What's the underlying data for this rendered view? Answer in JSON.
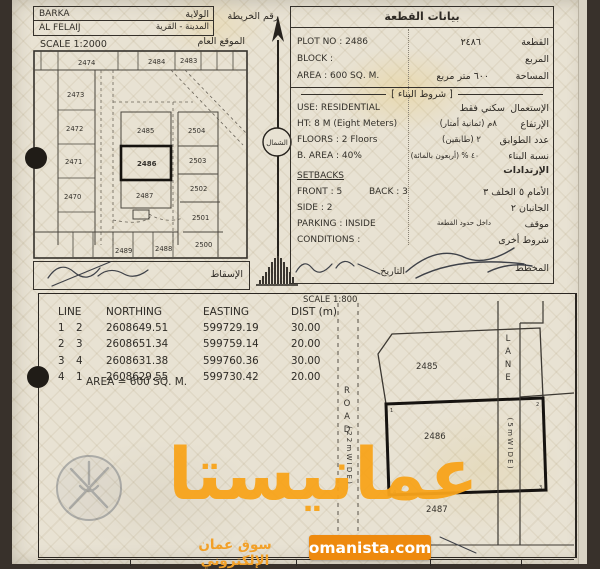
{
  "header": {
    "city": "BARKA",
    "village": "AL FELAIJ",
    "state_label": "الولاية",
    "city_village_label": "المدينة - القرية",
    "map_no_label": "رقم الخريطة"
  },
  "location_map": {
    "scale": "SCALE 1:2000",
    "title": "الموقع العام",
    "projection_label": "الإسقاط",
    "plots": {
      "p2474": "2474",
      "p2484": "2484",
      "p2483": "2483",
      "p2473": "2473",
      "p2472": "2472",
      "p2471": "2471",
      "p2470": "2470",
      "p2485": "2485",
      "p2486": "2486",
      "p2487": "2487",
      "p2504": "2504",
      "p2503": "2503",
      "p2502": "2502",
      "p2501": "2501",
      "p2500": "2500",
      "p2489": "2489",
      "p2488": "2488"
    }
  },
  "north": {
    "label": "الشمال"
  },
  "plot_data": {
    "title": "بيانات القطعة",
    "plot_no_en": "PLOT NO :  2486",
    "plot_no_ar": "٢٤٨٦",
    "plot_label_ar": "القطعة",
    "block_en": "BLOCK :",
    "block_label_ar": "المربع",
    "area_en": "AREA :  600 SQ. M.",
    "area_ar": "٦٠٠    متر مربع",
    "area_label_ar": "المساحة",
    "conditions_header_ar": "[ شروط البناء ]",
    "use_en": "USE: RESIDENTIAL",
    "use_ar": "سكني فقط",
    "use_label_ar": "الإستعمال",
    "ht_en": "HT: 8 M  (Eight Meters)",
    "ht_ar": "٨م  (ثمانية أمتار)",
    "ht_label_ar": "الإرتفاع",
    "floors_en": "FLOORS :  2 Floors",
    "floors_ar": "٢  (طابقين)",
    "floors_label_ar": "عدد الطوابق",
    "barea_en": "B. AREA :    40%",
    "barea_ar": "٤٠ %  (أربعون بالمائة)",
    "barea_label_ar": "نسبة البناء",
    "setbacks_en": "SETBACKS",
    "setbacks_label_ar": "الإرتدادات",
    "front_en": "FRONT : 5",
    "back_en": "BACK : 3",
    "front_back_ar": "الأمام   ٥        الخلف   ٣",
    "side_en": "SIDE :   2",
    "side_ar": "الجانبان        ٢",
    "parking_en": "PARKING : INSIDE",
    "parking_ar": "داخل حدود القطعة",
    "parking_label_ar": "موقف",
    "conditions_en": "CONDITIONS :",
    "conditions_label_ar": "شروط أخرى",
    "date_label_ar": "التاريخ",
    "planner_label_ar": "المخطط"
  },
  "survey": {
    "scale": "SCALE 1:800",
    "table": {
      "headers": [
        "LINE",
        "NORTHING",
        "EASTING",
        "DIST (m)"
      ],
      "rows": [
        [
          "1",
          "2",
          "2608649.51",
          "599729.19",
          "30.00"
        ],
        [
          "2",
          "3",
          "2608651.34",
          "599759.14",
          "20.00"
        ],
        [
          "3",
          "4",
          "2608631.38",
          "599760.36",
          "30.00"
        ],
        [
          "4",
          "1",
          "2608629.55",
          "599730.42",
          "20.00"
        ]
      ],
      "area_note": "AREA = 600 SQ. M."
    },
    "site_plan": {
      "road_label": "ROAD (22 m WIDE)",
      "road_letters": [
        "R",
        "O",
        "A",
        "D"
      ],
      "road_note": "( 2 2   m   W I D E )",
      "lane_label": "LANE (5 m WIDE)",
      "lane_letters": [
        "L",
        "A",
        "N",
        "E"
      ],
      "lane_note": "( 5   m   W I D E )",
      "plot_top": "2485",
      "plot_mid": "2486",
      "plot_bottom": "2487",
      "corners": {
        "c1": "1",
        "c2": "2",
        "c3": "3",
        "c4": "4"
      }
    }
  },
  "watermark": {
    "brand": "عمانيستا",
    "tagline": "سوق عمان الإلكتروني",
    "site": "omanista.com",
    "accent": "#f8a41b"
  }
}
